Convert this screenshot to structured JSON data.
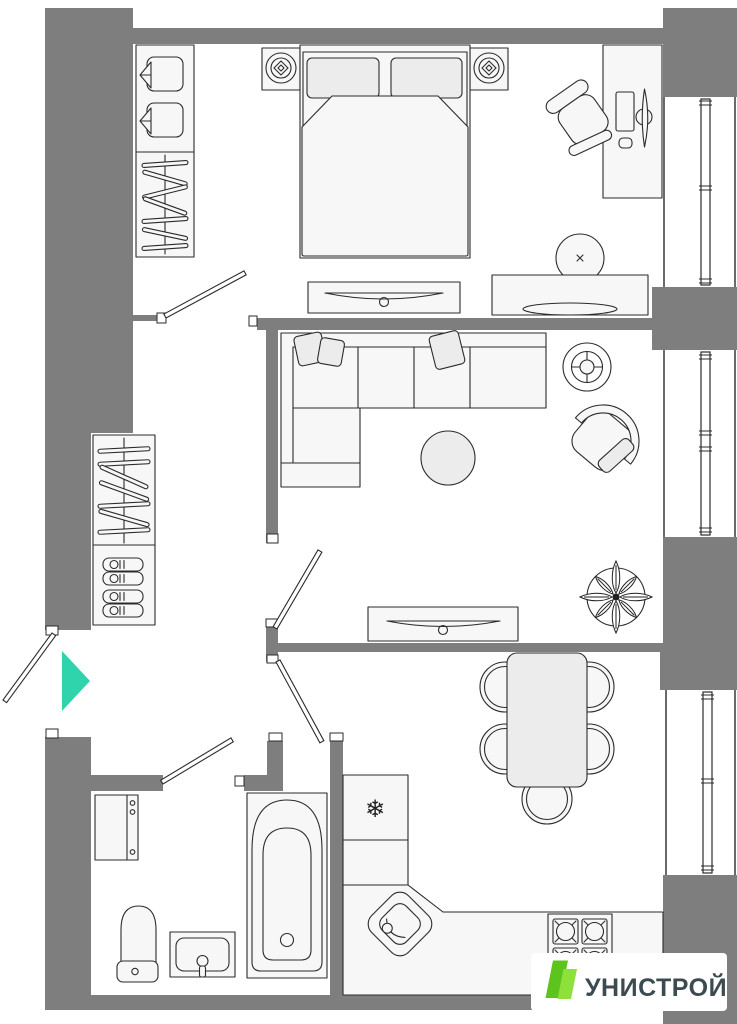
{
  "meta": {
    "type": "apartment-floor-plan",
    "orientation": "top-down"
  },
  "colors": {
    "background": "#ffffff",
    "wall": "#7e7e7e",
    "line": "#2b2b2b",
    "furniture_fill": "#f7f7f7",
    "soft_fill": "#ececec",
    "entrance_arrow": "#2fd3ac",
    "logo_green_primary": "#5cc41d",
    "logo_green_secondary": "#8ee03a",
    "logo_text_color": "#3c4a51"
  },
  "logo": {
    "text": "УНИСТРОЙ"
  },
  "symbols": {
    "fridge_snowflake": "❄"
  },
  "plan": {
    "bedroom": {
      "furniture": [
        "wardrobe-towels-hangers",
        "double-bed",
        "nightstand-left",
        "nightstand-right",
        "ceiling-lamp-left",
        "ceiling-lamp-right",
        "desk",
        "office-chair",
        "tv-console",
        "pouf",
        "dresser"
      ]
    },
    "living_room": {
      "furniture": [
        "corner-sofa",
        "cushions",
        "coffee-table",
        "ceiling-fan",
        "armchair",
        "tv-stand",
        "potted-plant"
      ]
    },
    "hallway": {
      "furniture": [
        "wardrobe-hangers",
        "shoe-shelf"
      ],
      "entrance_marker": "arrow-right"
    },
    "kitchen_dining": {
      "furniture": [
        "dining-table",
        "dining-chairs-x5",
        "fridge",
        "kitchen-cabinet",
        "corner-sink",
        "counter",
        "stove-4-burners"
      ]
    },
    "bathroom": {
      "furniture": [
        "washing-machine",
        "toilet",
        "sink-vanity",
        "bathtub"
      ]
    },
    "balconies": [
      "balcony-top",
      "balcony-middle",
      "balcony-bottom"
    ],
    "doors": [
      "entrance-door",
      "bedroom-door",
      "living-room-door",
      "kitchen-door",
      "bathroom-door"
    ]
  }
}
